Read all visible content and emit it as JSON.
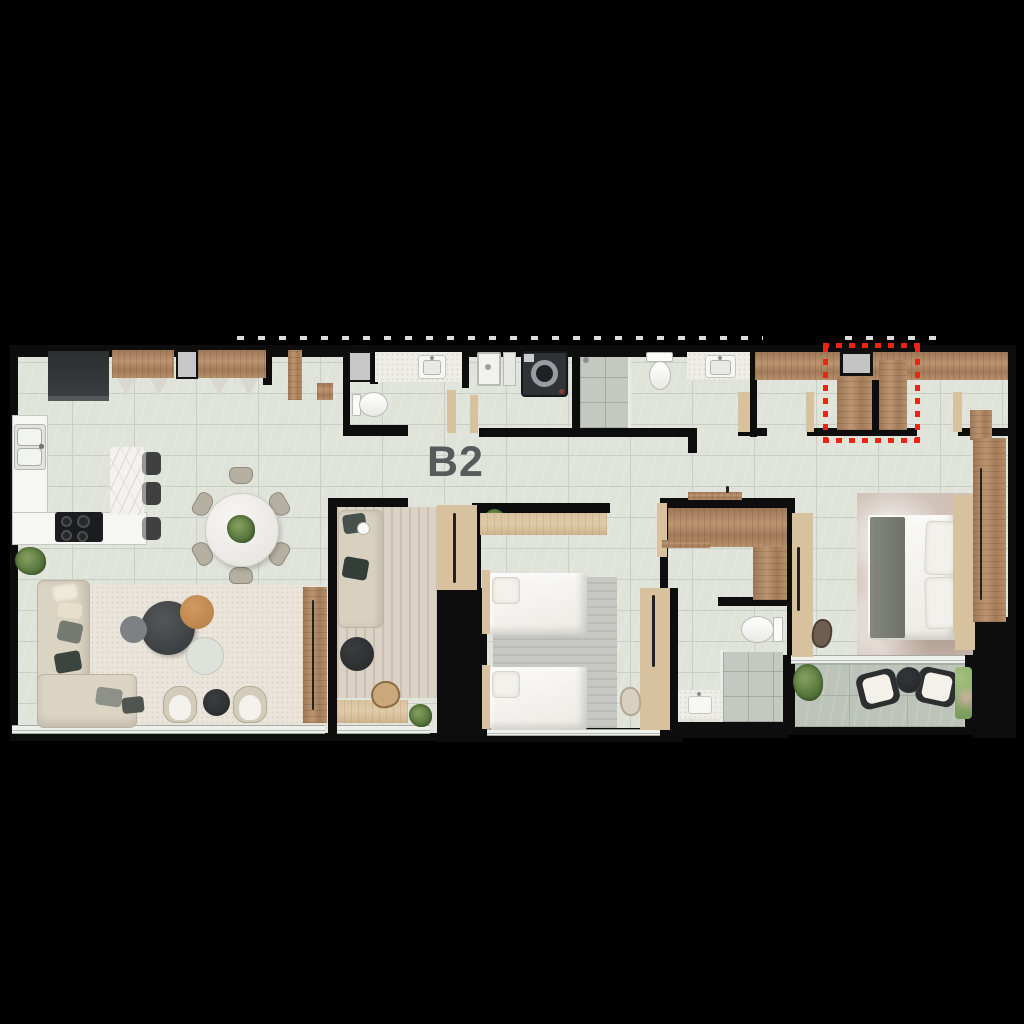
{
  "unit": {
    "label": "B2"
  },
  "annotations": {
    "highlight_box": {
      "style": "dotted-outline",
      "color": "#ee2413"
    },
    "top_edge_marks": "clipped white tick marks"
  },
  "colors": {
    "background": "#000000",
    "wall": "#0d0d0d",
    "floor": "#dfe3da",
    "floor_grout": "#c9cfc6",
    "balcony_floor": "#bcc3b9",
    "balcony_grout": "#a8afa5",
    "shower_floor": "#c3c9c0",
    "wood_dark": "#a5805e",
    "wood_light": "#d8c19e",
    "fixture_white": "#f6f6f3",
    "marble_white": "#f3f2ee",
    "label_gray": "#595a5c",
    "highlight_red": "#ee2413",
    "rug_living": "#eae4da",
    "rug_bedroom": "#c7c7c3",
    "rug_master": "#d0c2b8",
    "rug_den": "#dbd2c5",
    "sofa_beige": "#dcd4c3"
  },
  "furniture_icons": [
    "refrigerator",
    "kitchen-upper-cabinets",
    "pendant-lamps",
    "double-sink",
    "cooktop",
    "kitchen-island",
    "bar-stools",
    "dining-table",
    "dining-chairs",
    "centerpiece-plant",
    "sectional-sofa",
    "coffee-table-set",
    "armchairs",
    "side-table",
    "tv-console",
    "area-rug",
    "potted-plant",
    "toilet",
    "vanity-sink",
    "shower",
    "washing-machine",
    "service-shaft",
    "wardrobe",
    "walk-in-closet",
    "single-bed",
    "double-bed",
    "desk",
    "desk-chair",
    "lounge-chairs",
    "outdoor-table",
    "planter-box"
  ]
}
